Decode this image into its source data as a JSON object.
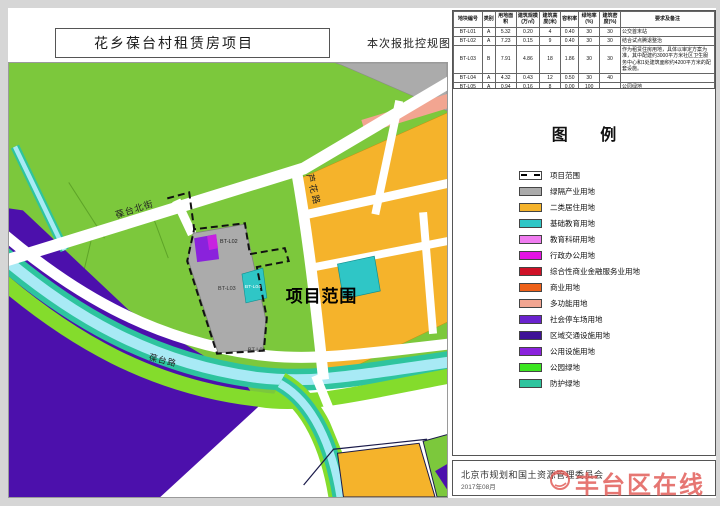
{
  "page": {
    "title": "花乡葆台村租赁房项目",
    "subtitle": "本次报批控规图"
  },
  "table": {
    "headers": [
      "地块编号",
      "类别",
      "用地面积",
      "建筑规模(万㎡)",
      "建筑高度(米)",
      "容积率",
      "绿地率(%)",
      "建筑密度(%)",
      "要求及备注"
    ],
    "rows": [
      [
        "BT-L01",
        "A",
        "5.32",
        "0.20",
        "4",
        "0.40",
        "30",
        "30",
        "公交首末站"
      ],
      [
        "BT-L02",
        "A",
        "7.23",
        "0.15",
        "9",
        "0.40",
        "30",
        "30",
        "结合试点腾退整治"
      ],
      [
        "BT-L03",
        "B",
        "7.91",
        "4.86",
        "18",
        "1.86",
        "30",
        "30",
        "作为租赁住房用地，具体以审定方案为准，其中配建约3000平方米社区卫生服务中心和1处建筑面积约4200平方米的配套设施。"
      ],
      [
        "BT-L04",
        "A",
        "4.32",
        "0.43",
        "12",
        "0.50",
        "30",
        "40",
        ""
      ],
      [
        "BT-L05",
        "A",
        "0.94",
        "0.16",
        "8",
        "0.00",
        "100",
        "",
        "公园绿地"
      ]
    ]
  },
  "legend": {
    "title": "图 例",
    "items": [
      {
        "label": "项目范围",
        "type": "dashed"
      },
      {
        "label": "绿隔产业用地",
        "color": "#ABABAB"
      },
      {
        "label": "二类居住用地",
        "color": "#F5B32B"
      },
      {
        "label": "基础教育用地",
        "color": "#2FC6C6"
      },
      {
        "label": "教育科研用地",
        "color": "#F07CF0"
      },
      {
        "label": "行政办公用地",
        "color": "#E312E3"
      },
      {
        "label": "综合性商业金融服务业用地",
        "color": "#CE1126"
      },
      {
        "label": "商业用地",
        "color": "#EE6018"
      },
      {
        "label": "多功能用地",
        "color": "#F2A591"
      },
      {
        "label": "社会停车场用地",
        "color": "#6A22CE"
      },
      {
        "label": "区域交通设施用地",
        "color": "#3F1196"
      },
      {
        "label": "公用设施用地",
        "color": "#8A22DC"
      },
      {
        "label": "公园绿地",
        "color": "#3BE620"
      },
      {
        "label": "防护绿地",
        "color": "#2EC49E"
      }
    ]
  },
  "map": {
    "labels": {
      "baotai_north_street": "葆台北街",
      "luhua_road": "芦花路",
      "baotai_road": "葆台路",
      "project_scope": "项目范围",
      "parcel_bt_l01": "BT-L01",
      "parcel_bt_l02": "BT-L02",
      "parcel_bt_l03": "BT-L03",
      "parcel_bt_l04": "BT-L04"
    },
    "colors": {
      "park_green": "#7CC83C",
      "band_green": "#84DC2C",
      "protect_teal": "#2EC49E",
      "water_blue": "#A8EAF5",
      "transport_purple": "#4C10AC",
      "residential_orange": "#F5B32B",
      "multi_salmon": "#F2A591",
      "industry_gray": "#ABABAB",
      "education_teal": "#2FC6C6",
      "utility_violet": "#8A22DC"
    }
  },
  "footer": {
    "authority": "北京市规划和国土资源管理委员会",
    "date": "2017年08月",
    "watermark": "丰台区在线"
  }
}
